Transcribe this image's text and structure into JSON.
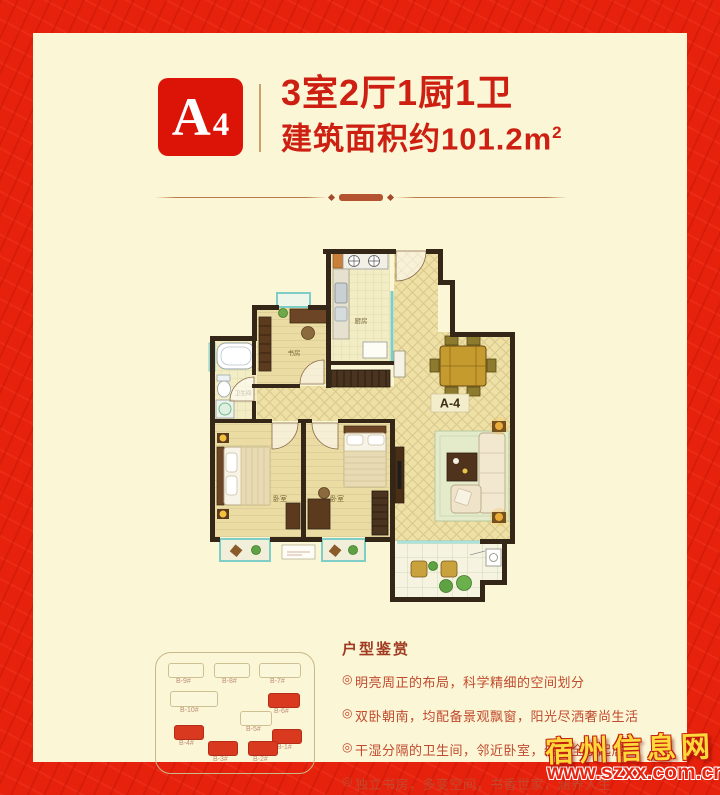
{
  "header": {
    "unit_badge": "A4",
    "unit_badge_big": "A",
    "unit_badge_small": "4",
    "title_line1": "3室2厅1厨1卫",
    "area_text": "建筑面积约101.2m",
    "area_sup": "2"
  },
  "floorplan": {
    "unit_label": "A-4",
    "labels": {
      "kitchen": "厨房",
      "study": "书房",
      "bathroom": "卫生间",
      "bedroom1": "卧室",
      "bedroom2": "卧室"
    }
  },
  "sitemap": {
    "buildings": [
      {
        "label": "B-9#",
        "highlighted": false
      },
      {
        "label": "B-8#",
        "highlighted": false
      },
      {
        "label": "B-7#",
        "highlighted": false
      },
      {
        "label": "B-10#",
        "highlighted": false
      },
      {
        "label": "B-6#",
        "highlighted": true
      },
      {
        "label": "B-5#",
        "highlighted": false
      },
      {
        "label": "B-4#",
        "highlighted": true
      },
      {
        "label": "B-1#",
        "highlighted": true
      },
      {
        "label": "B-3#",
        "highlighted": true
      },
      {
        "label": "B-2#",
        "highlighted": true
      }
    ]
  },
  "features": {
    "title": "户型鉴赏",
    "bullet": "◎",
    "items": [
      "明亮周正的布局，科学精细的空间划分",
      "双卧朝南，均配备景观飘窗，阳光尽洒奢尚生活",
      "干湿分隔的卫生间，邻近卧室，便捷全家起居",
      "独立书房，多变空间，书香世家，涵养人生"
    ]
  },
  "watermark": {
    "site_name": "宿州信息网",
    "site_url": "www.szxx.com.cn"
  },
  "colors": {
    "border_red": "#e7220c",
    "badge_red": "#dc1408",
    "heading_red": "#cd2013",
    "feature_red": "#c14a2e",
    "highlight_building_red": "#d8391f",
    "background_cream": "#fbf6d5"
  }
}
